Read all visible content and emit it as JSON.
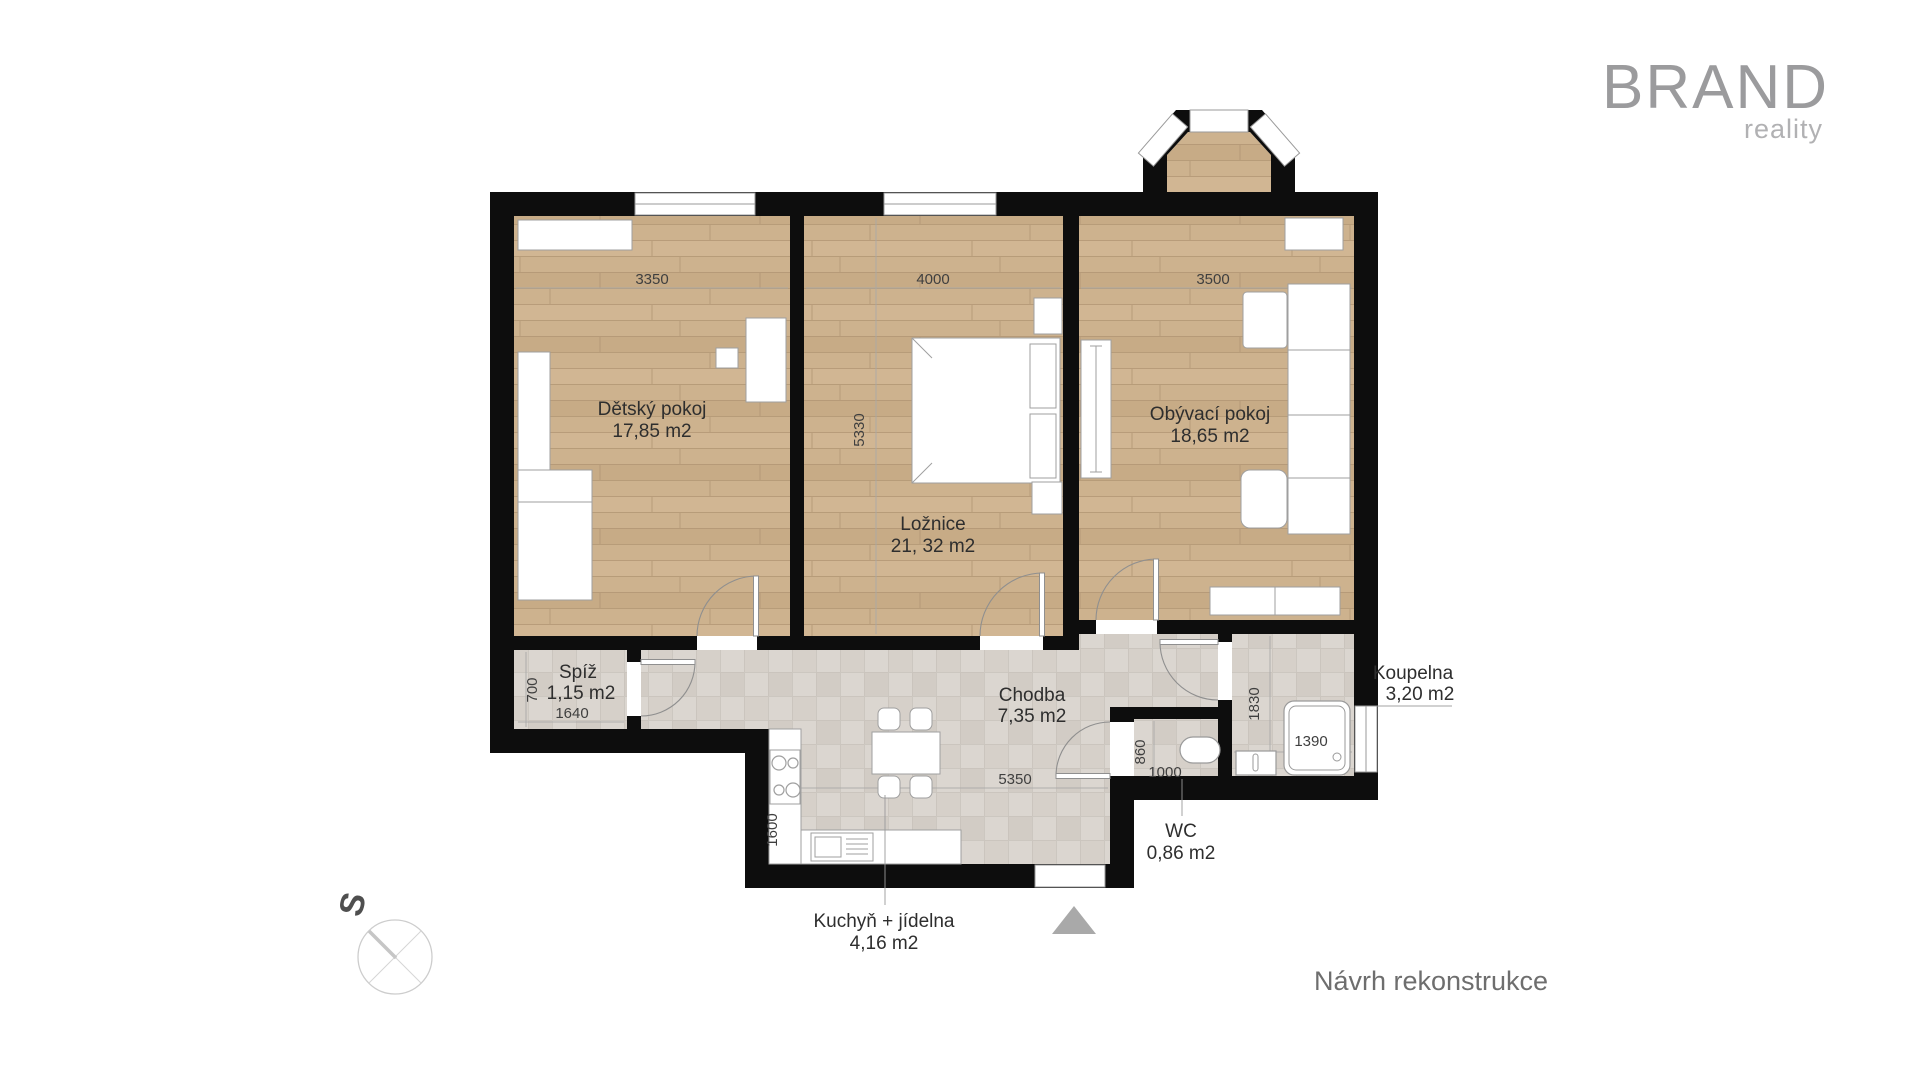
{
  "logo": {
    "brand": "BRAND",
    "tagline": "reality"
  },
  "caption": "Návrh rekonstrukce",
  "compass": {
    "label": "S"
  },
  "plan": {
    "rooms": {
      "detsky": {
        "name": "Dětský pokoj",
        "area": "17,85 m2",
        "dim_width": "3350"
      },
      "loznice": {
        "name": "Ložnice",
        "area": "21, 32 m2",
        "dim_width": "4000",
        "dim_height": "5330"
      },
      "obyvaci": {
        "name": "Obývací pokoj",
        "area": "18,65 m2",
        "dim_width": "3500"
      },
      "spiz": {
        "name": "Spíž",
        "area": "1,15 m2",
        "dim_width": "1640",
        "dim_height": "700"
      },
      "chodba": {
        "name": "Chodba",
        "area": "7,35 m2",
        "dim_width": "5350"
      },
      "kuchyn": {
        "name": "Kuchyň + jídelna",
        "area": "4,16 m2",
        "dim_height": "1600"
      },
      "koupelna": {
        "name": "Koupelna",
        "area": "3,20 m2",
        "dim_width": "1390",
        "dim_height": "1830"
      },
      "wc": {
        "name": "WC",
        "area": "0,86 m2",
        "dim_width": "1000",
        "dim_height": "860"
      }
    },
    "colors": {
      "wall": "#0d0d0d",
      "wood_floor": "#cdb28e",
      "tile_floor": "#dbd6d0",
      "furniture": "#ffffff",
      "logo_gray": "#9b9b9d",
      "caption_gray": "#6e6e6e",
      "entry_arrow_gray": "#a9a9a9"
    }
  }
}
